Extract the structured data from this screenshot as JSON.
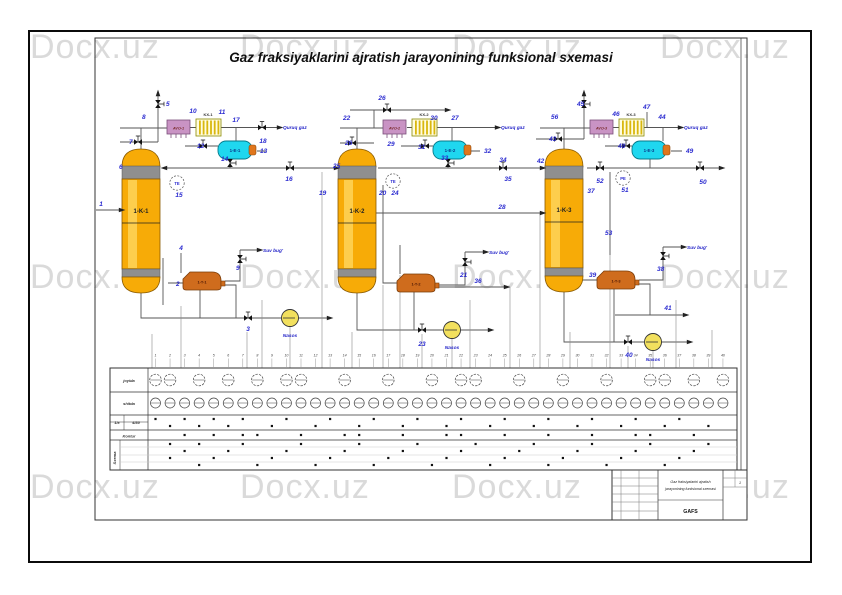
{
  "page": {
    "title": "Gaz fraksiyaklarini ajratish jarayonining funksional sxemasi",
    "watermark": "Docx.uz"
  },
  "palette": {
    "column_gold": "#f7ab07",
    "column_sheen": "#ffd965",
    "band_gray": "#8f8f8f",
    "cooler_pink": "#c993c4",
    "condenser_stripe": "#d9b70e",
    "exchanger_cyan": "#1fd7ef",
    "cap_orange": "#e0761c",
    "reboiler_orange": "#cf6c1d",
    "pump_yellow": "#f2e05e",
    "stream_number_blue": "#2b2bd0",
    "line_gray": "#555555",
    "watermark_gray": "#dadada"
  },
  "diagram": {
    "columns": [
      {
        "label": "1-K-1"
      },
      {
        "label": "1-K-2"
      },
      {
        "label": "1-K-3"
      }
    ],
    "coolers": [
      {
        "label": "AVO-1"
      },
      {
        "label": "AVO-2"
      },
      {
        "label": "AVO-3"
      }
    ],
    "condensers": [
      {
        "label": "KX-1"
      },
      {
        "label": "KX-2"
      },
      {
        "label": "KX-3"
      }
    ],
    "separators": [
      {
        "label": "1-E-1"
      },
      {
        "label": "1-E-2"
      },
      {
        "label": "1-E-3"
      }
    ],
    "reboilers": [
      {
        "label": "1-T-1"
      },
      {
        "label": "1-T-2"
      },
      {
        "label": "1-T-3"
      }
    ],
    "stream_texts": [
      {
        "t": "Quruq gaz",
        "x": 283,
        "y": 129,
        "a": "start"
      },
      {
        "t": "Quruq gaz",
        "x": 501,
        "y": 129,
        "a": "start"
      },
      {
        "t": "Quruq gaz",
        "x": 684,
        "y": 129,
        "a": "start"
      },
      {
        "t": "Suv bug'",
        "x": 263,
        "y": 252,
        "a": "start"
      },
      {
        "t": "Suv bug'",
        "x": 489,
        "y": 254,
        "a": "start"
      },
      {
        "t": "Suv bug'",
        "x": 687,
        "y": 249,
        "a": "start"
      },
      {
        "t": "Nasos",
        "x": 290,
        "y": 337,
        "a": "middle"
      },
      {
        "t": "Nasos",
        "x": 452,
        "y": 349,
        "a": "middle"
      },
      {
        "t": "Nasos",
        "x": 653,
        "y": 361,
        "a": "middle"
      }
    ],
    "stream_numbers": [
      {
        "t": "1",
        "x": 101,
        "y": 206
      },
      {
        "t": "2",
        "x": 176,
        "y": 286,
        "a": "end"
      },
      {
        "t": "3",
        "x": 248,
        "y": 331
      },
      {
        "t": "4",
        "x": 181,
        "y": 250
      },
      {
        "t": "5",
        "x": 166,
        "y": 106,
        "a": "start"
      },
      {
        "t": "6",
        "x": 119,
        "y": 169,
        "a": "end"
      },
      {
        "t": "7",
        "x": 129,
        "y": 144,
        "a": "end"
      },
      {
        "t": "8",
        "x": 142,
        "y": 119,
        "a": "end"
      },
      {
        "t": "9",
        "x": 236,
        "y": 270,
        "a": "end"
      },
      {
        "t": "10",
        "x": 193,
        "y": 113
      },
      {
        "t": "11",
        "x": 222,
        "y": 114
      },
      {
        "t": "12",
        "x": 197,
        "y": 148,
        "a": "end"
      },
      {
        "t": "13",
        "x": 260,
        "y": 153,
        "a": "start"
      },
      {
        "t": "14",
        "x": 221,
        "y": 161,
        "a": "end"
      },
      {
        "t": "16",
        "x": 289,
        "y": 181
      },
      {
        "t": "17",
        "x": 236,
        "y": 122
      },
      {
        "t": "18",
        "x": 263,
        "y": 143
      },
      {
        "t": "19",
        "x": 319,
        "y": 195,
        "a": "end"
      },
      {
        "t": "20",
        "x": 379,
        "y": 195,
        "a": "end"
      },
      {
        "t": "21",
        "x": 460,
        "y": 277,
        "a": "end"
      },
      {
        "t": "22",
        "x": 343,
        "y": 120,
        "a": "end"
      },
      {
        "t": "23",
        "x": 422,
        "y": 346
      },
      {
        "t": "25",
        "x": 333,
        "y": 168,
        "a": "end"
      },
      {
        "t": "26",
        "x": 382,
        "y": 100
      },
      {
        "t": "26",
        "x": 345,
        "y": 145,
        "a": "end"
      },
      {
        "t": "27",
        "x": 455,
        "y": 120
      },
      {
        "t": "28",
        "x": 502,
        "y": 209
      },
      {
        "t": "29",
        "x": 391,
        "y": 146
      },
      {
        "t": "30",
        "x": 434,
        "y": 120
      },
      {
        "t": "31",
        "x": 418,
        "y": 149,
        "a": "end"
      },
      {
        "t": "32",
        "x": 484,
        "y": 153,
        "a": "start"
      },
      {
        "t": "33",
        "x": 441,
        "y": 160,
        "a": "end"
      },
      {
        "t": "34",
        "x": 503,
        "y": 162
      },
      {
        "t": "35",
        "x": 508,
        "y": 181
      },
      {
        "t": "36",
        "x": 478,
        "y": 283
      },
      {
        "t": "37",
        "x": 591,
        "y": 193
      },
      {
        "t": "38",
        "x": 657,
        "y": 271,
        "a": "end"
      },
      {
        "t": "39",
        "x": 589,
        "y": 277,
        "a": "end"
      },
      {
        "t": "40",
        "x": 629,
        "y": 357
      },
      {
        "t": "41",
        "x": 668,
        "y": 310
      },
      {
        "t": "42",
        "x": 537,
        "y": 163,
        "a": "end"
      },
      {
        "t": "43",
        "x": 549,
        "y": 141,
        "a": "end"
      },
      {
        "t": "44",
        "x": 662,
        "y": 119
      },
      {
        "t": "45",
        "x": 577,
        "y": 106,
        "a": "end"
      },
      {
        "t": "46",
        "x": 616,
        "y": 116
      },
      {
        "t": "47",
        "x": 643,
        "y": 109,
        "a": "end"
      },
      {
        "t": "48",
        "x": 618,
        "y": 148,
        "a": "end"
      },
      {
        "t": "49",
        "x": 686,
        "y": 153,
        "a": "start"
      },
      {
        "t": "50",
        "x": 703,
        "y": 184
      },
      {
        "t": "52",
        "x": 600,
        "y": 183
      },
      {
        "t": "53",
        "x": 605,
        "y": 235,
        "a": "end"
      },
      {
        "t": "56",
        "x": 551,
        "y": 119,
        "a": "end"
      }
    ],
    "instruments": [
      {
        "tag": "TE",
        "no": "15",
        "x": 177,
        "y": 183
      },
      {
        "tag": "TE",
        "no": "24",
        "x": 393,
        "y": 181
      },
      {
        "tag": "PE",
        "no": "51",
        "x": 623,
        "y": 178
      }
    ],
    "valves": [
      {
        "x": 158,
        "y": 104,
        "o": "v"
      },
      {
        "x": 138,
        "y": 142,
        "o": "h"
      },
      {
        "x": 203,
        "y": 146,
        "o": "h"
      },
      {
        "x": 262,
        "y": 127.5,
        "o": "h"
      },
      {
        "x": 230,
        "y": 163,
        "o": "v"
      },
      {
        "x": 290,
        "y": 168,
        "o": "h"
      },
      {
        "x": 240,
        "y": 259,
        "o": "v"
      },
      {
        "x": 248,
        "y": 318,
        "o": "h"
      },
      {
        "x": 387,
        "y": 110,
        "o": "h"
      },
      {
        "x": 352,
        "y": 143,
        "o": "h"
      },
      {
        "x": 425,
        "y": 146,
        "o": "h"
      },
      {
        "x": 448,
        "y": 163,
        "o": "v"
      },
      {
        "x": 503,
        "y": 168,
        "o": "h"
      },
      {
        "x": 465,
        "y": 262,
        "o": "v"
      },
      {
        "x": 422,
        "y": 330,
        "o": "h"
      },
      {
        "x": 584,
        "y": 104,
        "o": "v"
      },
      {
        "x": 558,
        "y": 139,
        "o": "h"
      },
      {
        "x": 626,
        "y": 146,
        "o": "h"
      },
      {
        "x": 600,
        "y": 168,
        "o": "h"
      },
      {
        "x": 700,
        "y": 168,
        "o": "h"
      },
      {
        "x": 663,
        "y": 256,
        "o": "v"
      },
      {
        "x": 628,
        "y": 342,
        "o": "h"
      }
    ],
    "arrows": [
      {
        "x": 122,
        "y": 210,
        "d": "r"
      },
      {
        "x": 164,
        "y": 168,
        "d": "l"
      },
      {
        "x": 337,
        "y": 168,
        "d": "r"
      },
      {
        "x": 543,
        "y": 168,
        "d": "r"
      },
      {
        "x": 722,
        "y": 168,
        "d": "r"
      },
      {
        "x": 543,
        "y": 213,
        "d": "r"
      },
      {
        "x": 280,
        "y": 127.5,
        "d": "r"
      },
      {
        "x": 498,
        "y": 127.5,
        "d": "r"
      },
      {
        "x": 681,
        "y": 127.5,
        "d": "r"
      },
      {
        "x": 158,
        "y": 93,
        "d": "u"
      },
      {
        "x": 584,
        "y": 93,
        "d": "u"
      },
      {
        "x": 448,
        "y": 110,
        "d": "r"
      },
      {
        "x": 260,
        "y": 250,
        "d": "r"
      },
      {
        "x": 486,
        "y": 252,
        "d": "r"
      },
      {
        "x": 684,
        "y": 247,
        "d": "r"
      },
      {
        "x": 330,
        "y": 318,
        "d": "r"
      },
      {
        "x": 491,
        "y": 330,
        "d": "r"
      },
      {
        "x": 690,
        "y": 342,
        "d": "r"
      },
      {
        "x": 507,
        "y": 287,
        "d": "r"
      },
      {
        "x": 686,
        "y": 315,
        "d": "r"
      }
    ],
    "signals": [
      {
        "x": 152,
        "y1": 334,
        "y2": 452
      },
      {
        "x": 181,
        "y1": 306,
        "y2": 430
      },
      {
        "x": 247,
        "y1": 332,
        "y2": 440
      },
      {
        "x": 262,
        "y1": 300,
        "y2": 414
      },
      {
        "x": 290,
        "y1": 327,
        "y2": 392
      },
      {
        "x": 322,
        "y1": 172,
        "y2": 452
      },
      {
        "x": 352,
        "y1": 332,
        "y2": 440
      },
      {
        "x": 383,
        "y1": 285,
        "y2": 414
      },
      {
        "x": 400,
        "y1": 275,
        "y2": 392
      },
      {
        "x": 422,
        "y1": 334,
        "y2": 452
      },
      {
        "x": 452,
        "y1": 339,
        "y2": 414
      },
      {
        "x": 470,
        "y1": 300,
        "y2": 440
      },
      {
        "x": 510,
        "y1": 287,
        "y2": 414
      },
      {
        "x": 540,
        "y1": 213,
        "y2": 452
      },
      {
        "x": 570,
        "y1": 332,
        "y2": 392
      },
      {
        "x": 610,
        "y1": 255,
        "y2": 430
      },
      {
        "x": 628,
        "y1": 346,
        "y2": 452
      },
      {
        "x": 653,
        "y1": 351,
        "y2": 414
      },
      {
        "x": 676,
        "y1": 300,
        "y2": 440
      },
      {
        "x": 712,
        "y1": 330,
        "y2": 392
      }
    ]
  },
  "table": {
    "row1_label": "joyida",
    "row2_label": "shitda",
    "cell_a": "1/x",
    "cell_b": "4/30",
    "row3_label": "Kontur",
    "group_label": "Sxema",
    "cols": 40,
    "rowA_cols": [
      0,
      1,
      3,
      5,
      7,
      9,
      10,
      13,
      16,
      19,
      21,
      22,
      25,
      28,
      31,
      34,
      35,
      37,
      39
    ],
    "dots": {
      "419": [
        0,
        2,
        4,
        6,
        9,
        12,
        15,
        18,
        21,
        24,
        27,
        30,
        33,
        36
      ],
      "426": [
        1,
        3,
        5,
        8,
        11,
        14,
        17,
        20,
        23,
        26,
        29,
        32,
        35,
        38
      ],
      "435": [
        2,
        4,
        6,
        7,
        10,
        13,
        14,
        17,
        20,
        21,
        24,
        27,
        30,
        33,
        34,
        37
      ],
      "444": [
        1,
        3,
        6,
        10,
        14,
        18,
        22,
        26,
        30,
        34,
        38
      ],
      "451": [
        2,
        5,
        9,
        13,
        17,
        21,
        25,
        29,
        33,
        37
      ],
      "458": [
        1,
        4,
        8,
        12,
        16,
        20,
        24,
        28,
        32,
        36
      ],
      "465": [
        3,
        7,
        11,
        15,
        19,
        23,
        27,
        31,
        35
      ]
    }
  },
  "title_block": {
    "line1": "Gaz fraksiyalarini ajratish",
    "line2": "jarayonining funksional sxemasi",
    "code": "GAFS",
    "sheet_no": "1"
  }
}
